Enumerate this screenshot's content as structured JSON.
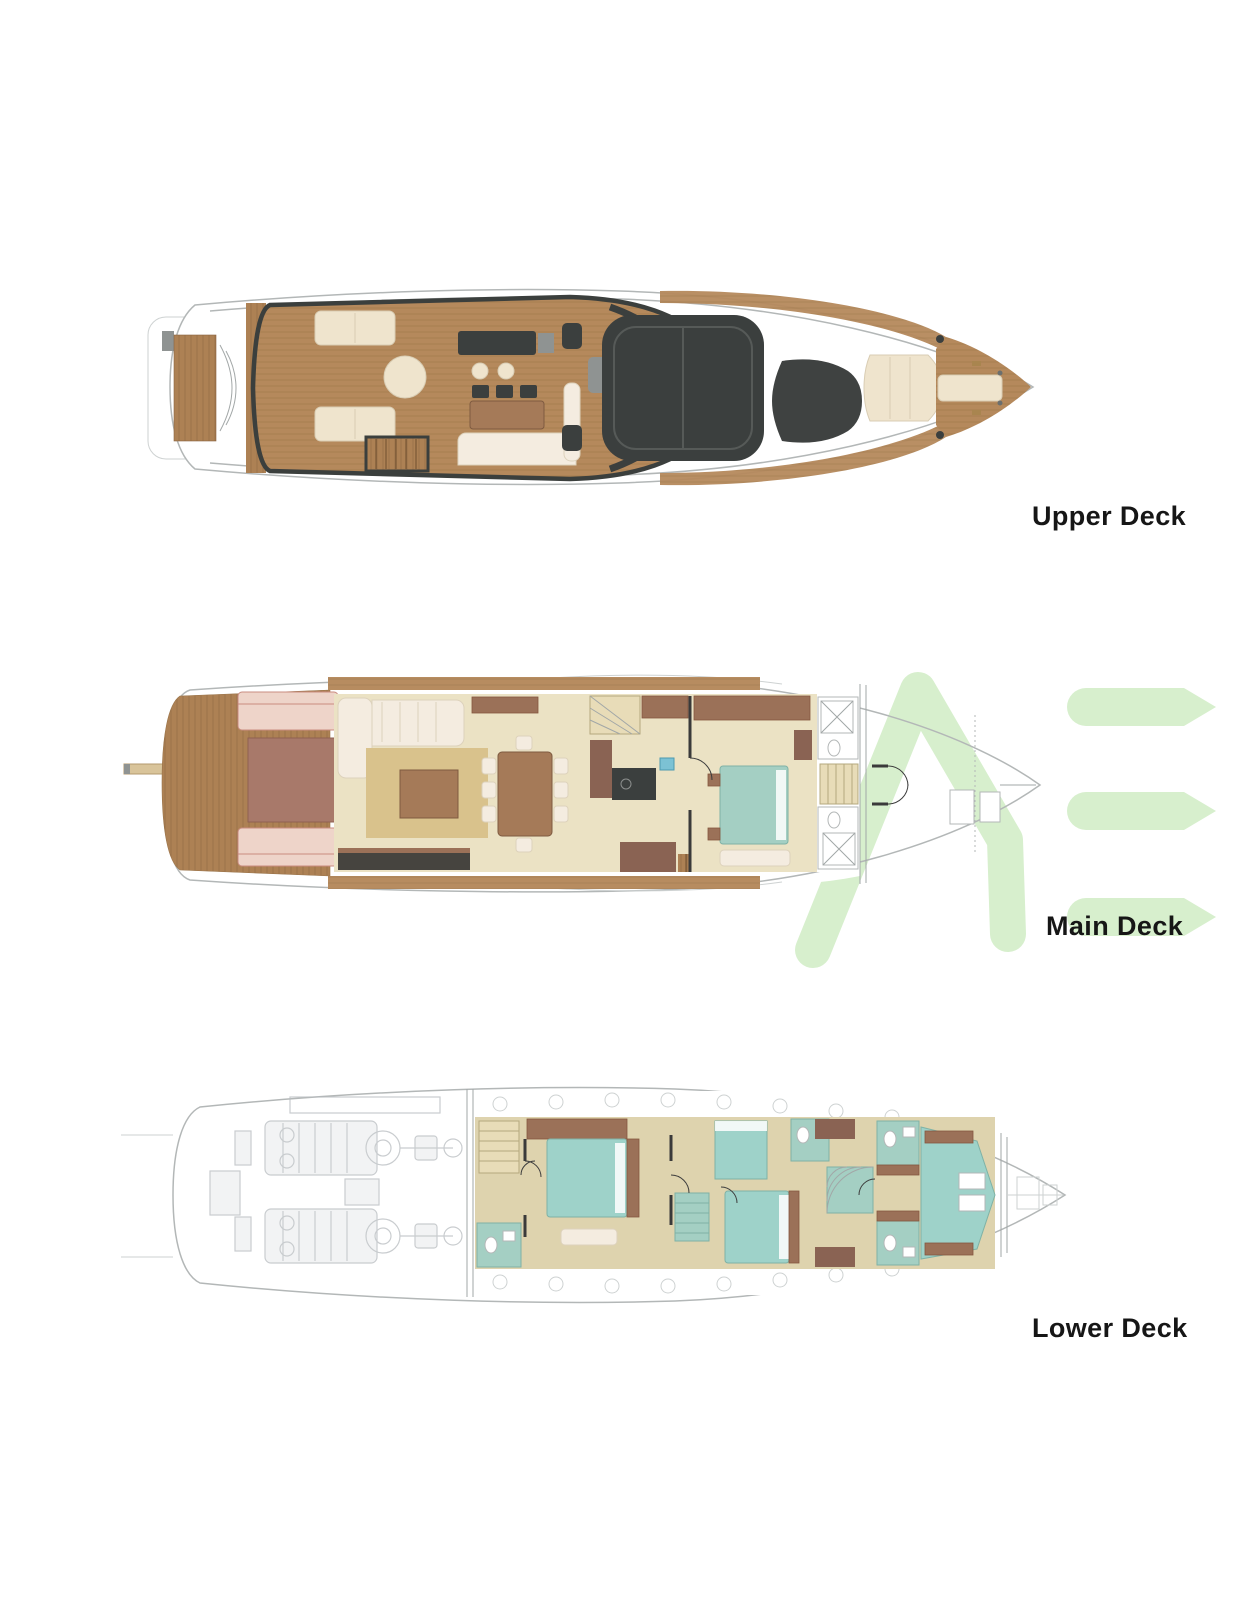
{
  "decks": [
    {
      "label": "Upper Deck"
    },
    {
      "label": "Main Deck"
    },
    {
      "label": "Lower Deck"
    }
  ],
  "watermark": {
    "visible_letters": "ME",
    "color": "#d7efcd"
  },
  "palette": {
    "background": "#ffffff",
    "label_text": "#161616",
    "hull_line": "#b3b7b7",
    "teak_wood": "#b5895c",
    "dark_glass": "#3b3f3e",
    "cream_upholstery": "#efe4cd",
    "pink_sunpad": "#eed4c9",
    "teal_bed": "#9ed2c9",
    "beige_floor": "#ebe2c4",
    "tan_rug": "#d9c28c",
    "brown_furniture": "#9b7158",
    "engine_gray": "#b7bcbf",
    "watermark_green": "#d7efcd"
  }
}
